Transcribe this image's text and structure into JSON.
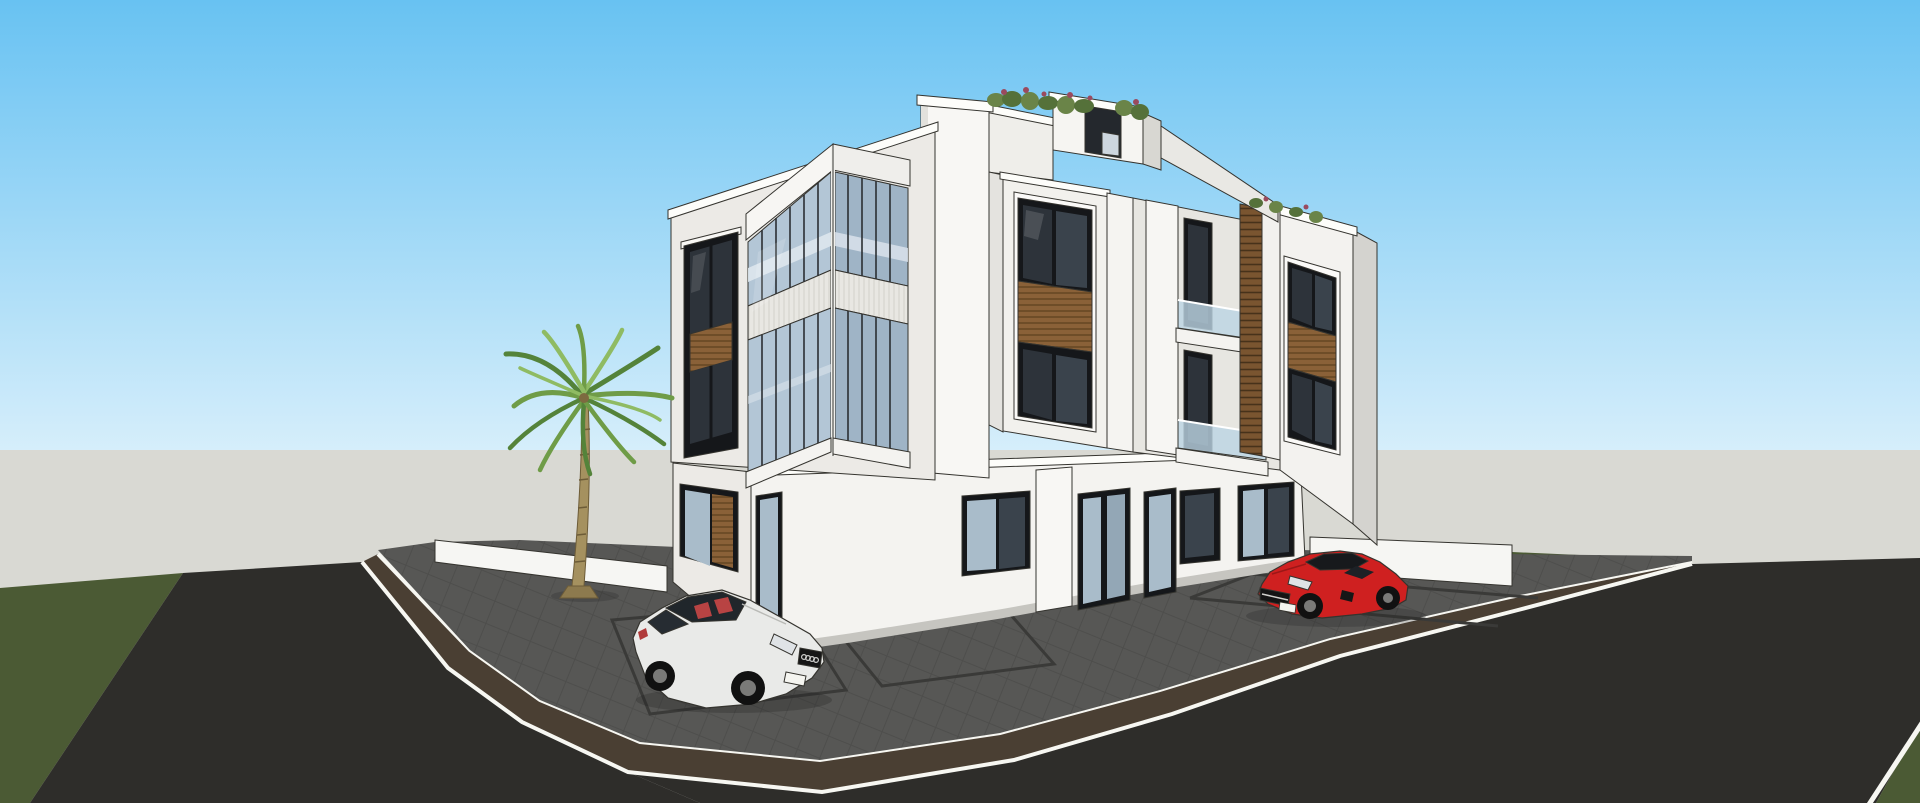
{
  "scene": {
    "title": "3D architectural rendering - modern three-story white corner residential building with rooftop planters, palm tree, grey paver parking apron and two parked cars",
    "render_style": "SketchUp-style shaded render with black edge lines",
    "sky": "clear day, blue gradient sky",
    "camera": "street-corner perspective view"
  },
  "objects": {
    "building": {
      "label": "three-story modern white building",
      "floors": 3,
      "features": [
        "corner glass curtain-wall bay with ribbed white spandrel band",
        "dark aluminium windows with wood-slat spandrel panels",
        "recessed balconies with frameless glass railings",
        "vertical wood louver screen",
        "rooftop parapet planters with red-green shrubs",
        "penthouse stair bulkhead",
        "ground floor glass doors and shop-style openings"
      ]
    },
    "palm_tree": {
      "label": "single palm tree in front of left boundary wall"
    },
    "white_car": {
      "label": "white coupe with red interior parked in marked bay"
    },
    "red_car": {
      "label": "red sports coupe with black roof parked along right frontage"
    },
    "ground": {
      "left_road": "dark asphalt street, left",
      "right_road": "dark asphalt street, right",
      "sidewalk": "brown paver sidewalk band with white curbs wrapping the corner",
      "parking_apron": "grey paver apron with dark parking bay outlines",
      "lawn": "dark green grass strips",
      "horizon": "flat light grey ground plane"
    },
    "walls": {
      "left": "low white boundary wall",
      "right": "low white boundary wall"
    }
  },
  "palette": {
    "sky_top": "#68c2f2",
    "sky_horizon": "#d8effb",
    "ground_plane": "#d9d9d3",
    "grass": "#4b5a34",
    "asphalt": "#2e2d2a",
    "sidewalk_paver": "#4a3f33",
    "curb_white": "#f7f7f2",
    "apron_paver": "#575755",
    "marking_line": "#3a3a38",
    "facade_front": "#f4f3f0",
    "facade_side": "#eceae6",
    "facade_dark": "#d4d3cf",
    "fin_white": "#f8f7f4",
    "coping_white": "#fdfdfa",
    "recess_gray": "#cfcec9",
    "ribbed_band": "#e8e7e2",
    "glass_curtain": "#b3c6d6",
    "glass_curtain_shade": "#9fb4c6",
    "glass_dark": "#2d333a",
    "glass_door": "#a9bcca",
    "frame_dark": "#15171a",
    "mullion_dark": "#2b2f33",
    "slab_reflection": "#dde5ed",
    "wood_slat": "#8a6138",
    "wood_slat_line": "#5f421f",
    "louver_wood": "#7a5530",
    "railing_glass": "#bcd4e4",
    "wall_white": "#f6f6f3",
    "plant_green": "#6a8448",
    "plant_green_dark": "#55713a",
    "plant_red": "#9a4a5e",
    "palm_trunk": "#a5915f",
    "palm_trunk_line": "#6d5c38",
    "frond_green": "#6f9c47",
    "frond_dark": "#54833a",
    "frond_light": "#8fbb63",
    "car_white": "#e9eae8",
    "car_glass": "#20262b",
    "car_seat_red": "#b84343",
    "car_red": "#cf2020",
    "car_roof_black": "#17191c",
    "tire_black": "#111111",
    "rim_gray": "#7a7a78",
    "headlight": "#dfe3e6",
    "plate_white": "#f5f5f0",
    "edge_line": "#35342f"
  }
}
